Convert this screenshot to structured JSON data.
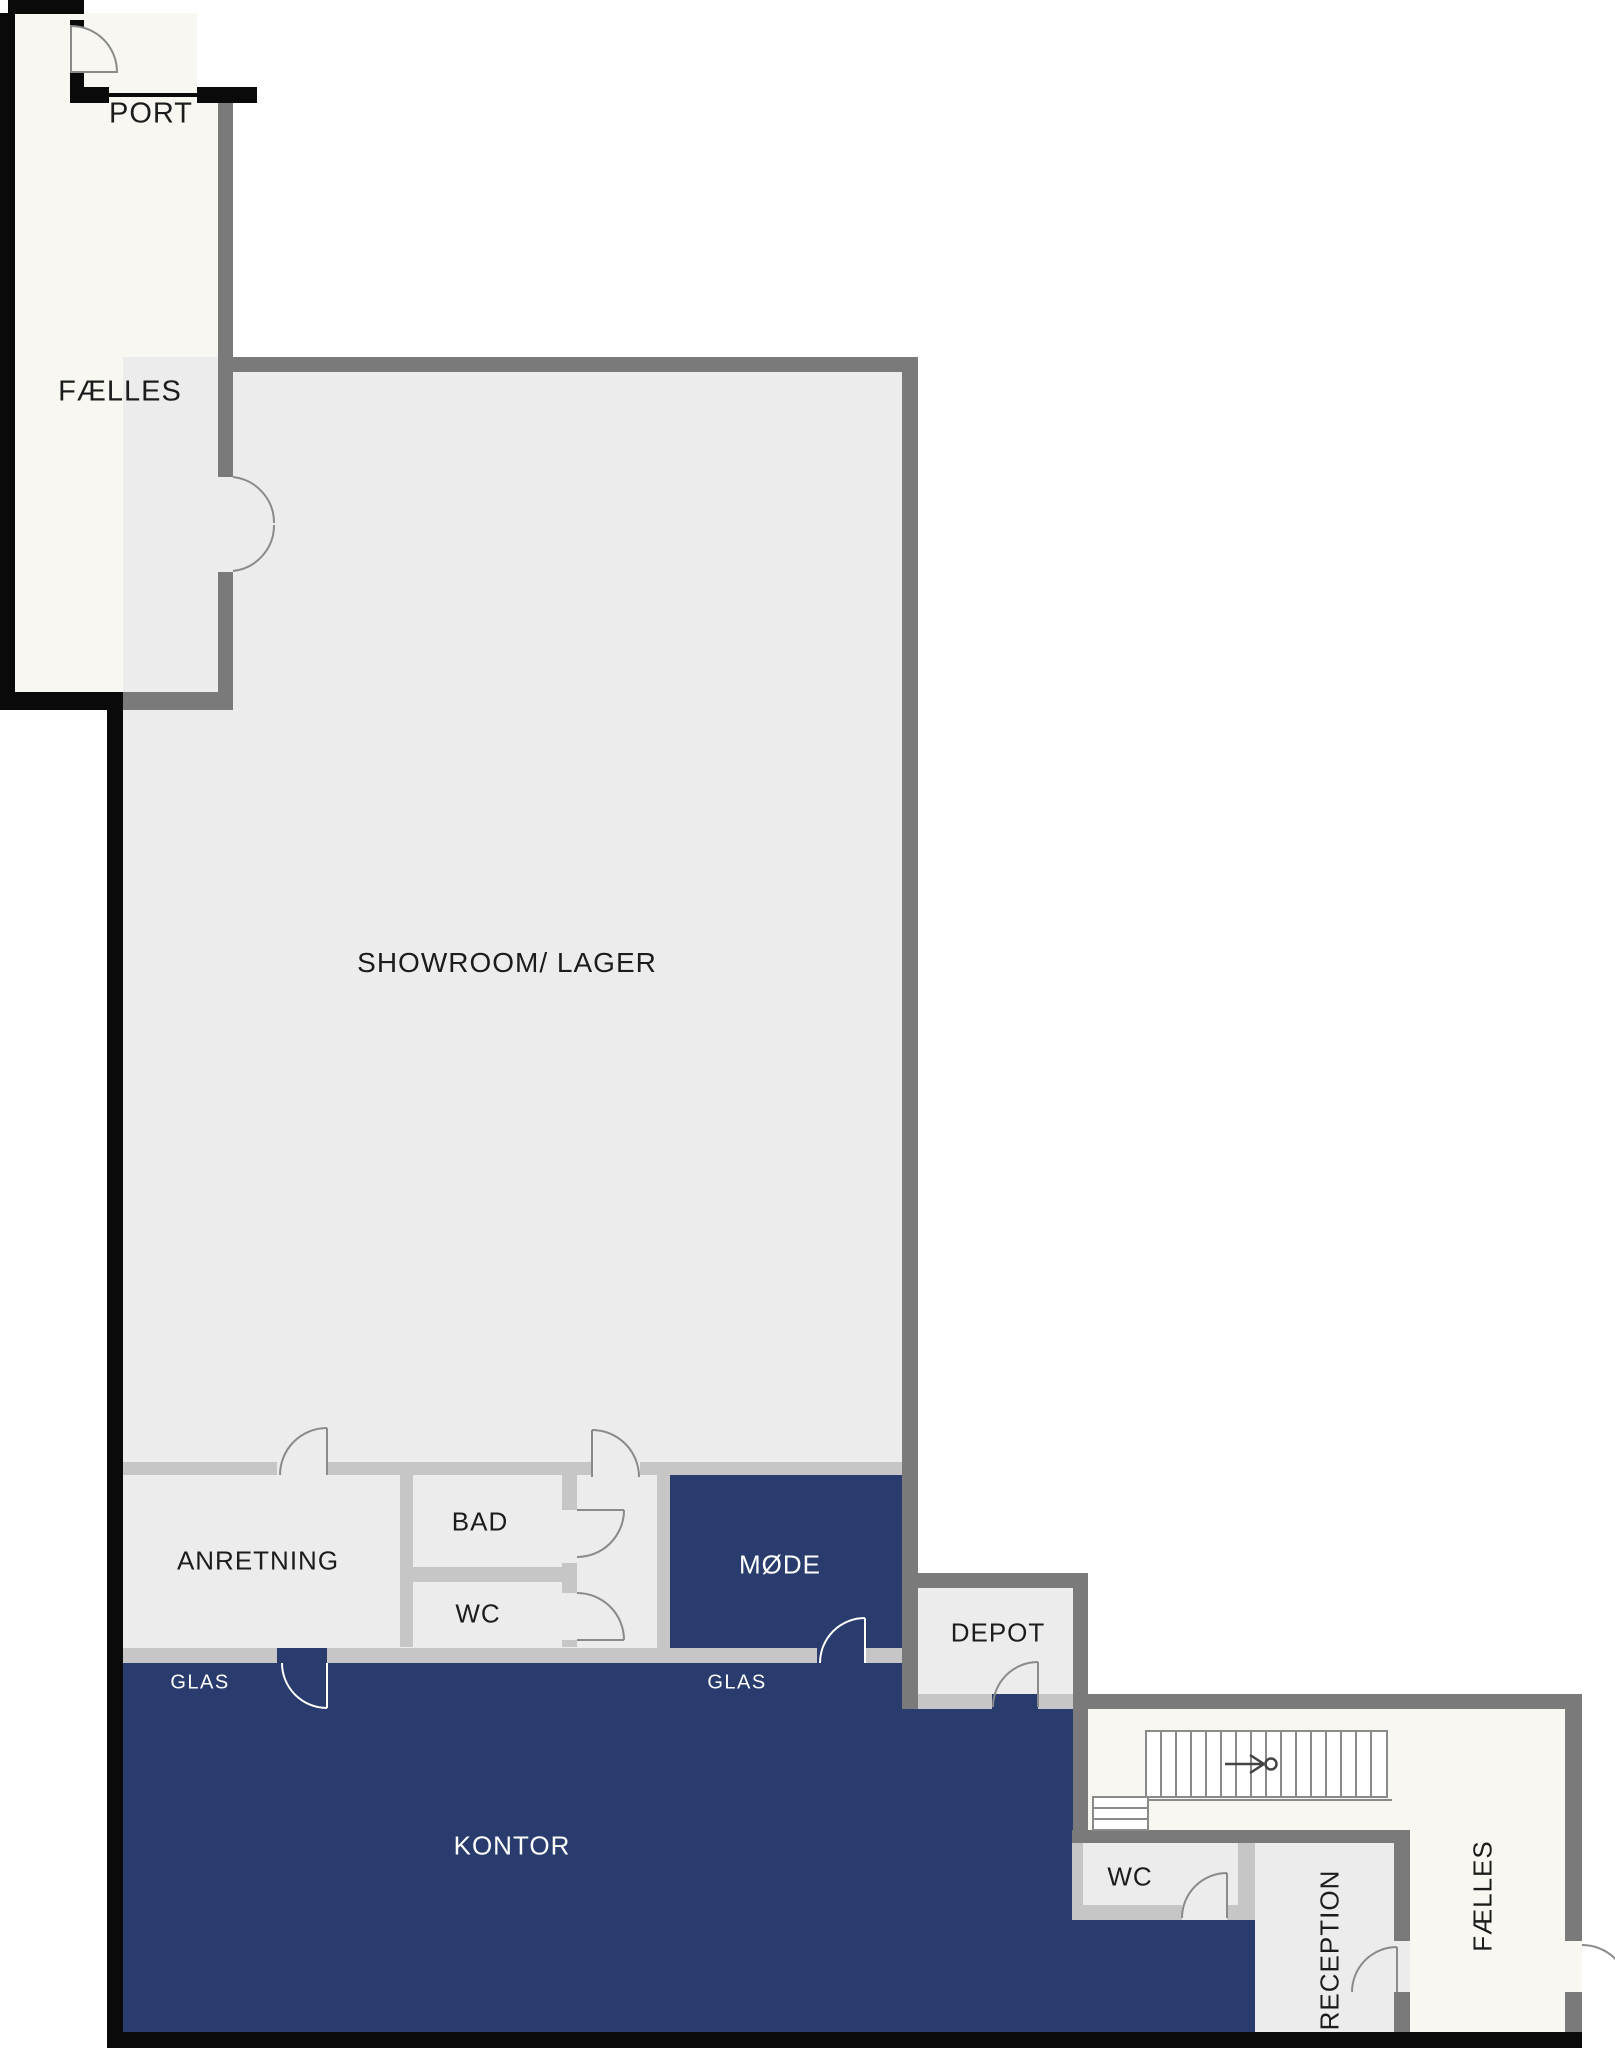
{
  "title": "Floor plan",
  "colors": {
    "wall_dark": "#7a7a7a",
    "wall_light": "#c6c6c6",
    "wall_black": "#0a0a0a",
    "floor_light": "#ececec",
    "floor_offwhite": "#f8f7f1",
    "floor_accent": "#2a3c6e",
    "label_dark": "#1c1c1c",
    "label_light": "#ffffff",
    "door_stroke": "#8a8a8a"
  },
  "rooms": {
    "port": {
      "label": "PORT"
    },
    "faelles_top": {
      "label": "FÆLLES"
    },
    "showroom": {
      "label": "SHOWROOM/ LAGER"
    },
    "anretning": {
      "label": "ANRETNING"
    },
    "bad": {
      "label": "BAD"
    },
    "wc_mid": {
      "label": "WC"
    },
    "moede": {
      "label": "MØDE"
    },
    "depot": {
      "label": "DEPOT"
    },
    "kontor": {
      "label": "KONTOR"
    },
    "glas_left": {
      "label": "GLAS"
    },
    "glas_right": {
      "label": "GLAS"
    },
    "wc_bottom": {
      "label": "WC"
    },
    "reception": {
      "label": "RECEPTION"
    },
    "faelles_bottom": {
      "label": "FÆLLES"
    }
  }
}
